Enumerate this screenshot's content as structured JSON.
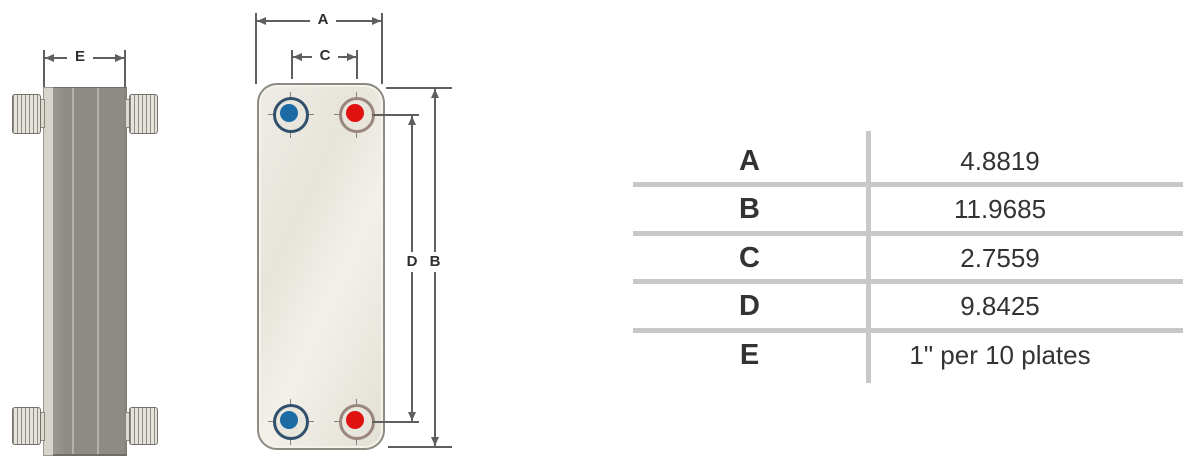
{
  "colors": {
    "dim_line": "#5f5f5f",
    "dim_text": "#2f2f2f",
    "table_line": "#c8c8c8",
    "table_text": "#333333",
    "plate_border": "#8d8a82",
    "stack_gray": "#8e8b85",
    "port_blue": "#1d6ba4",
    "port_red": "#e01111"
  },
  "side_view": {
    "width_dim_label": "E"
  },
  "front_view": {
    "overall_width_dim_label": "A",
    "port_spacing_width_dim_label": "C",
    "port_spacing_height_dim_label": "D",
    "overall_height_dim_label": "B",
    "ports": [
      {
        "position": "top-left",
        "color": "blue"
      },
      {
        "position": "top-right",
        "color": "red"
      },
      {
        "position": "bottom-left",
        "color": "blue"
      },
      {
        "position": "bottom-right",
        "color": "red"
      }
    ]
  },
  "table": {
    "rows": [
      {
        "label": "A",
        "value": "4.8819"
      },
      {
        "label": "B",
        "value": "11.9685"
      },
      {
        "label": "C",
        "value": "2.7559"
      },
      {
        "label": "D",
        "value": "9.8425"
      },
      {
        "label": "E",
        "value": "1\" per 10 plates"
      }
    ]
  }
}
